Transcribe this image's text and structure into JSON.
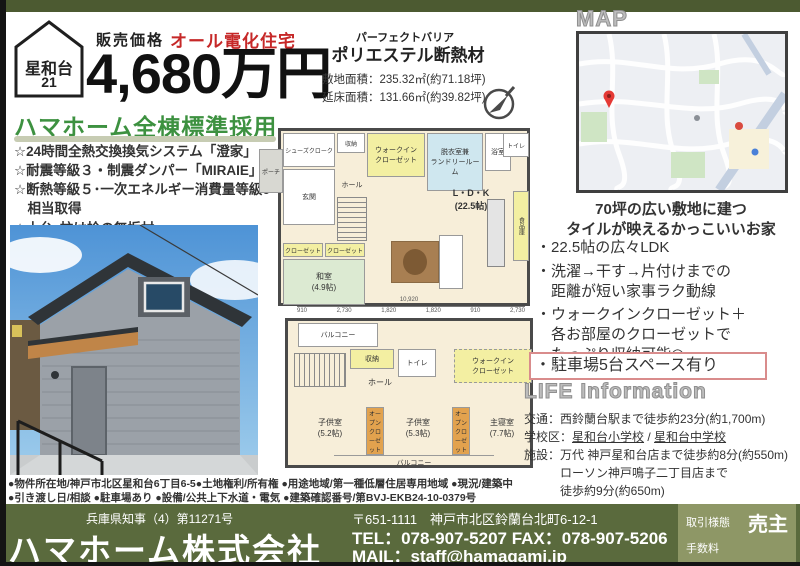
{
  "badge": {
    "name": "星和台",
    "number": "21"
  },
  "header": {
    "price_label": "販売価格",
    "all_electric": "オール電化住宅",
    "price": "4,680万円",
    "insulation_small": "パーフェクトバリア",
    "insulation": "ポリエステル断熱材",
    "site_area": "敷地面積：235.32㎡(約71.18坪)",
    "floor_area": "延床面積：131.66㎡(約39.82坪)"
  },
  "standard": {
    "heading": "ハマホーム全棟標準採用",
    "items": [
      "☆24時間全熱交換換気システム「澄家」",
      "☆耐震等級３・制震ダンパー「MIRAIE」",
      "☆断熱等級５･一次エネルギー消費量等級6",
      "　相当取得",
      "☆土台･柱は桧の無垢材"
    ]
  },
  "map": {
    "label": "MAP"
  },
  "features": {
    "caption": "70坪の広い敷地に建つ\nタイルが映えるかっこいいお家",
    "bullet1": "・22.5帖の広々LDK",
    "bullet2": "・洗濯→干す→片付けまでの\n　距離が短い家事ラク動線",
    "bullet3": "・ウォークインクローゼット＋\n　各お部屋のクローゼットで\n　たっぷり収納可能◎",
    "highlight": "・駐車場5台スペース有り"
  },
  "life": {
    "heading": "LIFE Information",
    "kotsu": "交通：西鈴蘭台駅まで徒歩約23分(約1,700m)",
    "gakko_label": "学校区：",
    "school1": "星和台小学校",
    "school_sep": " / ",
    "school2": "星和台中学校",
    "shisetsu1": "施設：万代 神戸星和台店まで徒歩約8分(約550m)",
    "shisetsu2": "　　　ローソン神戸鳴子二丁目店まで",
    "shisetsu3": "　　　徒歩約9分(約650m)"
  },
  "fp1": {
    "shoes": "シューズクローク",
    "storage": "収納",
    "wic": "ウォークイン\nクローゼット",
    "wash": "脱衣室兼\nランドリールーム",
    "bath": "浴室",
    "toilet": "トイレ",
    "porch": "ポーチ",
    "entrance": "玄関",
    "hall": "ホール",
    "ldk": "L・D・K\n(22.5帖)",
    "pantry": "食品庫",
    "closet_a": "クローゼット",
    "closet_b": "クローゼット",
    "washitsu": "和室\n(4.9帖)"
  },
  "fp2": {
    "balcony_top": "バルコニー",
    "storage": "収納",
    "toilet": "トイレ",
    "hall": "ホール",
    "wic": "ウォークイン\nクローゼット",
    "kids1": "子供室\n(5.2帖)",
    "open_closet1": "オープン\nクローゼット",
    "kids2": "子供室\n(5.3帖)",
    "open_closet2": "オープン\nクローゼット",
    "master": "主寝室\n(7.7帖)",
    "balcony_bottom": "バルコニー",
    "dim_total": "10,920",
    "dims": [
      "910",
      "2,730",
      "1,820",
      "1,820",
      "910",
      "2,730"
    ]
  },
  "fineprint": {
    "line1": "●物件所在地/神戸市北区星和台6丁目6-5●土地権利/所有権 ●用途地域/第一種低層住居専用地域 ●現況/建築中",
    "line2": "●引き渡し日/相談 ●駐車場あり ●設備/公共上下水道・電気 ●建築確認番号/第BVJ-EKB24-10-0379号"
  },
  "footer": {
    "license": "兵庫県知事（4）第11271号",
    "company": "ハマホーム株式会社",
    "address": "〒651-1111　神戸市北区鈴蘭台北町6-12-1",
    "tel": "TEL：078-907-5207  FAX：078-907-5206",
    "mail": "MAIL：staff@hamagami.jp",
    "deal_label": "取引様態",
    "deal_value": "売主",
    "fee_label": "手数料"
  },
  "colors": {
    "band_green": "#5a6a3d",
    "topbar_green": "#4c5a31",
    "accent_red": "#c62828",
    "heading_green": "#3d9140",
    "highlight_border": "#d98c8c",
    "deal_box": "#8e9766"
  }
}
